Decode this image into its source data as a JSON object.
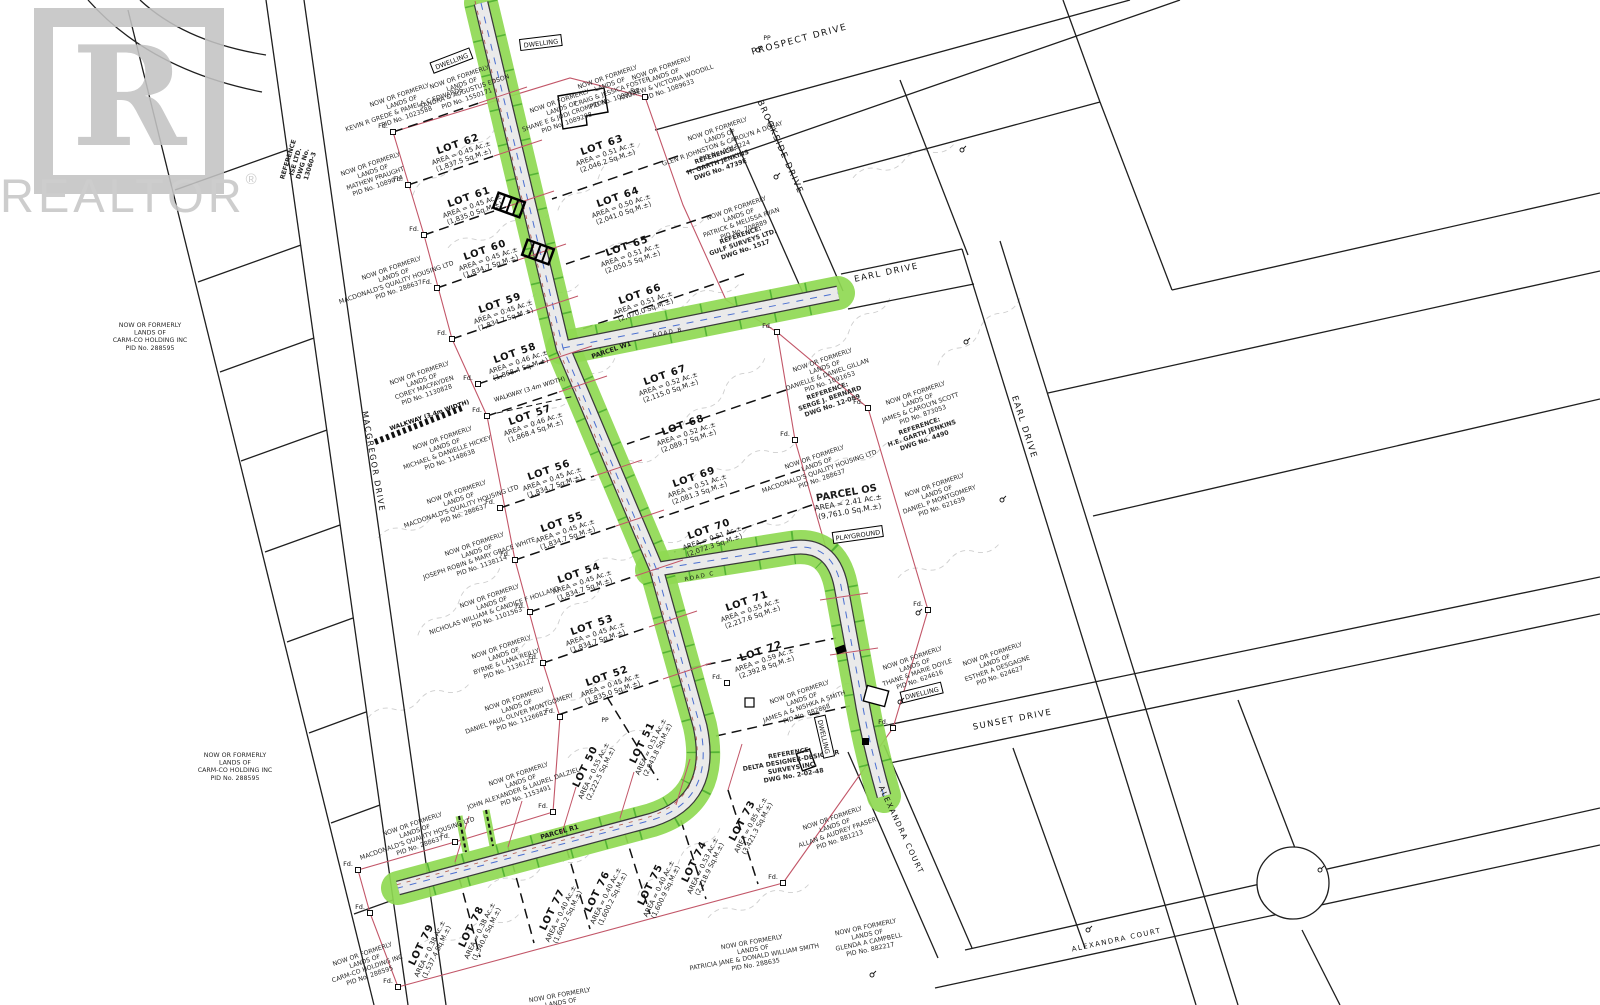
{
  "watermark": {
    "logo_letter": "R",
    "brand": "REALTOR",
    "registered": "®"
  },
  "colors": {
    "road_green": "#8fd952",
    "road_green_tick": "#2f9e1f",
    "road_surface": "#eaeaea",
    "road_edge": "#3a3a3a",
    "boundary_red": "#c25668",
    "parcel_line": "#1f1f1f",
    "contour_gray": "#c6c6c6",
    "centerline_blue": "#4a6fd0",
    "utility_red": "#b05548",
    "watermark_gray": "#c3c3c3"
  },
  "road_labels": [
    {
      "text": "PROSPECT DRIVE",
      "x": 800,
      "y": 42,
      "rot": -15,
      "size": 9
    },
    {
      "text": "BROOKSIDE DRIVE",
      "x": 778,
      "y": 148,
      "rot": 66,
      "size": 8.5
    },
    {
      "text": "EARL DRIVE",
      "x": 887,
      "y": 275,
      "rot": -12,
      "size": 8.5
    },
    {
      "text": "EARL DRIVE",
      "x": 1022,
      "y": 428,
      "rot": 72,
      "size": 8.5
    },
    {
      "text": "SUNSET DRIVE",
      "x": 1013,
      "y": 722,
      "rot": -11,
      "size": 8.5
    },
    {
      "text": "ALEXANDRA COURT",
      "x": 899,
      "y": 831,
      "rot": 65,
      "size": 7.5
    },
    {
      "text": "ALEXANDRA COURT",
      "x": 1117,
      "y": 942,
      "rot": -12,
      "size": 7
    },
    {
      "text": "MACGREGOR DRIVE",
      "x": 371,
      "y": 462,
      "rot": 80,
      "size": 8
    },
    {
      "text": "ROAD B",
      "x": 668,
      "y": 334,
      "rot": -11,
      "size": 5.5
    },
    {
      "text": "ROAD C",
      "x": 700,
      "y": 578,
      "rot": -12,
      "size": 5.5
    }
  ],
  "parcel_labels": [
    {
      "lines": [
        "PARCEL W1"
      ],
      "x": 612,
      "y": 352,
      "rot": -19,
      "size": 6.5,
      "bold": true
    },
    {
      "lines": [
        "PARCEL R1"
      ],
      "x": 560,
      "y": 834,
      "rot": -16,
      "size": 6.5,
      "bold": true
    },
    {
      "lines": [
        "PARCEL OS",
        "AREA = 2.41 Ac.±",
        "(9,761.0 Sq.M.±)"
      ],
      "x": 847,
      "y": 496,
      "rot": -10,
      "size": 10,
      "bold": true,
      "subsize": 7.5
    }
  ],
  "lots": [
    {
      "name": "LOT 62",
      "area": "AREA = 0.45 Ac.±",
      "sqm": "(1,837.5 Sq.M.±)",
      "x": 459,
      "y": 147,
      "rot": -19
    },
    {
      "name": "LOT 61",
      "area": "AREA = 0.45 Ac.±",
      "sqm": "(1,835.0 Sq.M.±)",
      "x": 470,
      "y": 200,
      "rot": -19
    },
    {
      "name": "LOT 60",
      "area": "AREA = 0.45 Ac.±",
      "sqm": "(1,834.7 Sq.M.±)",
      "x": 486,
      "y": 253,
      "rot": -19
    },
    {
      "name": "LOT 59",
      "area": "AREA = 0.45 Ac.±",
      "sqm": "(1,834.7 Sq.M.±)",
      "x": 501,
      "y": 306,
      "rot": -19
    },
    {
      "name": "LOT 58",
      "area": "AREA = 0.46 Ac.±",
      "sqm": "(1,868.4 Sq.M.±)",
      "x": 516,
      "y": 356,
      "rot": -19
    },
    {
      "name": "LOT 57",
      "area": "AREA = 0.46 Ac.±",
      "sqm": "(1,868.4 Sq.M.±)",
      "x": 531,
      "y": 418,
      "rot": -19
    },
    {
      "name": "LOT 56",
      "area": "AREA = 0.45 Ac.±",
      "sqm": "(1,834.7 Sq.M.±)",
      "x": 550,
      "y": 473,
      "rot": -19
    },
    {
      "name": "LOT 55",
      "area": "AREA = 0.45 Ac.±",
      "sqm": "(1,834.7 Sq.M.±)",
      "x": 563,
      "y": 525,
      "rot": -19
    },
    {
      "name": "LOT 54",
      "area": "AREA = 0.45 Ac.±",
      "sqm": "(1,834.7 Sq.M.±)",
      "x": 580,
      "y": 576,
      "rot": -19
    },
    {
      "name": "LOT 53",
      "area": "AREA = 0.45 Ac.±",
      "sqm": "(1,834.7 Sq.M.±)",
      "x": 593,
      "y": 628,
      "rot": -19
    },
    {
      "name": "LOT 52",
      "area": "AREA = 0.45 Ac.±",
      "sqm": "(1,835.0 Sq.M.±)",
      "x": 608,
      "y": 679,
      "rot": -19
    },
    {
      "name": "LOT 63",
      "area": "AREA = 0.51 Ac.±",
      "sqm": "(2,046.2 Sq.M.±)",
      "x": 603,
      "y": 148,
      "rot": -19
    },
    {
      "name": "LOT 64",
      "area": "AREA = 0.50 Ac.±",
      "sqm": "(2,041.0 Sq.M.±)",
      "x": 619,
      "y": 200,
      "rot": -19
    },
    {
      "name": "LOT 65",
      "area": "AREA = 0.51 Ac.±",
      "sqm": "(2,050.5 Sq.M.±)",
      "x": 628,
      "y": 249,
      "rot": -19
    },
    {
      "name": "LOT 66",
      "area": "AREA = 0.51 Ac.±",
      "sqm": "(2,070.0 Sq.M.±)",
      "x": 641,
      "y": 297,
      "rot": -19
    },
    {
      "name": "LOT 67",
      "area": "AREA = 0.52 Ac.±",
      "sqm": "(2,115.0 Sq.M.±)",
      "x": 666,
      "y": 378,
      "rot": -19
    },
    {
      "name": "LOT 68",
      "area": "AREA = 0.52 Ac.±",
      "sqm": "(2,089.7 Sq.M.±)",
      "x": 684,
      "y": 428,
      "rot": -19
    },
    {
      "name": "LOT 69",
      "area": "AREA = 0.51 Ac.±",
      "sqm": "(2,081.3 Sq.M.±)",
      "x": 695,
      "y": 480,
      "rot": -19
    },
    {
      "name": "LOT 70",
      "area": "AREA = 0.51 Ac.±",
      "sqm": "(2,072.3 Sq.M.±)",
      "x": 710,
      "y": 532,
      "rot": -19
    },
    {
      "name": "LOT 71",
      "area": "AREA = 0.55 Ac.±",
      "sqm": "(2,217.6 Sq.M.±)",
      "x": 748,
      "y": 604,
      "rot": -19
    },
    {
      "name": "LOT 72",
      "area": "AREA = 0.59 Ac.±",
      "sqm": "(2,392.8 Sq.M.±)",
      "x": 762,
      "y": 654,
      "rot": -19
    },
    {
      "name": "LOT 50",
      "area": "AREA = 0.55 Ac.±",
      "sqm": "(2,222.5 Sq.M.±)",
      "x": 588,
      "y": 768,
      "rot": -64
    },
    {
      "name": "LOT 51",
      "area": "AREA = 0.51 Ac.±",
      "sqm": "(2,043.8 Sq.M.±)",
      "x": 645,
      "y": 744,
      "rot": -64
    },
    {
      "name": "LOT 73",
      "area": "AREA = 0.85 Ac.±",
      "sqm": "(3,421.3 Sq.M.±)",
      "x": 745,
      "y": 822,
      "rot": -62
    },
    {
      "name": "LOT 74",
      "area": "AREA = 0.53 Ac.±",
      "sqm": "(2,118.9 Sq.M.±)",
      "x": 697,
      "y": 863,
      "rot": -64
    },
    {
      "name": "LOT 75",
      "area": "AREA = 0.40 Ac.±",
      "sqm": "(1,600.9 Sq.M.±)",
      "x": 653,
      "y": 886,
      "rot": -64
    },
    {
      "name": "LOT 76",
      "area": "AREA = 0.40 Ac.±",
      "sqm": "(1,600.2 Sq.M.±)",
      "x": 600,
      "y": 893,
      "rot": -64
    },
    {
      "name": "LOT 77",
      "area": "AREA = 0.40 Ac.±",
      "sqm": "(1,600.2 Sq.M.±)",
      "x": 555,
      "y": 911,
      "rot": -64
    },
    {
      "name": "LOT 78",
      "area": "AREA = 0.38 Ac.±",
      "sqm": "(1,540.6 Sq.M.±)",
      "x": 474,
      "y": 928,
      "rot": -64
    },
    {
      "name": "LOT 79",
      "area": "AREA = 0.38 Ac.±",
      "sqm": "(1,537.4 Sq.M.±)",
      "x": 424,
      "y": 946,
      "rot": -64
    }
  ],
  "owners": [
    {
      "lines": [
        "NOW OR FORMERLY",
        "LANDS OF",
        "CARM-CO HOLDING INC",
        "PID No. 288595"
      ],
      "x": 150,
      "y": 327,
      "rot": 0
    },
    {
      "lines": [
        "NOW OR FORMERLY",
        "LANDS OF",
        "CARM-CO HOLDING INC",
        "PID No. 288595"
      ],
      "x": 235,
      "y": 757,
      "rot": 0
    },
    {
      "lines": [
        "NOW OR FORMERLY",
        "LANDS OF",
        "CARM-CO HOLDING INC",
        "PID No. 288595"
      ],
      "x": 363,
      "y": 956,
      "rot": -19
    },
    {
      "lines": [
        "NOW OR FORMERLY",
        "LANDS OF",
        "KEVIN R GREDE & PAMELA C EDWARDS",
        "PID No. 1023588"
      ],
      "x": 400,
      "y": 97,
      "rot": -19
    },
    {
      "lines": [
        "NOW OR FORMERLY",
        "LANDS OF",
        "MATHEW PRAUGHT",
        "PID No. 1089074"
      ],
      "x": 371,
      "y": 166,
      "rot": -19
    },
    {
      "lines": [
        "NOW OR FORMERLY",
        "LANDS OF",
        "SANDRA & AUGUSTUS EDSON",
        "PID No. 1550171"
      ],
      "x": 460,
      "y": 79,
      "rot": -19
    },
    {
      "lines": [
        "NOW OR FORMERLY",
        "LANDS OF",
        "SHANE E & JODI CROMPTON",
        "PID No. 1089208"
      ],
      "x": 560,
      "y": 103,
      "rot": -19
    },
    {
      "lines": [
        "NOW OR FORMERLY",
        "LANDS OF",
        "CRAIG & JESSICA FOSTER",
        "PID No. 1089187"
      ],
      "x": 608,
      "y": 79,
      "rot": -19
    },
    {
      "lines": [
        "NOW OR FORMERLY",
        "LANDS OF",
        "ANDREW & VICTORIA WOODILL",
        "PID No. 1089633"
      ],
      "x": 662,
      "y": 70,
      "rot": -19
    },
    {
      "lines": [
        "NOW OR FORMERLY",
        "LANDS OF",
        "GLEN R JOHNSTON & CAROLYN A DUSAY",
        "PID No. 1018224"
      ],
      "x": 718,
      "y": 131,
      "rot": -19
    },
    {
      "lines": [
        "REFERENCE:",
        "H. GARTH JENKINS",
        "DWG No. 4739E"
      ],
      "x": 716,
      "y": 157,
      "rot": -19,
      "bold": true
    },
    {
      "lines": [
        "NOW OR FORMERLY",
        "LANDS OF",
        "PATRICK & MELISSA RYAN",
        "PID No. 708889"
      ],
      "x": 737,
      "y": 210,
      "rot": -19
    },
    {
      "lines": [
        "REFERENCE:",
        "GULF SURVEYS LTD.",
        "DWG No. 1517"
      ],
      "x": 741,
      "y": 237,
      "rot": -19,
      "bold": true
    },
    {
      "lines": [
        "NOW OR FORMERLY",
        "LANDS OF",
        "MACDONALD'S QUALITY HOUSING LTD",
        "PID No. 288637"
      ],
      "x": 392,
      "y": 270,
      "rot": -19
    },
    {
      "lines": [
        "NOW OR FORMERLY",
        "LANDS OF",
        "COREY MACFAYDEN",
        "PID No. 1130828"
      ],
      "x": 420,
      "y": 375,
      "rot": -19
    },
    {
      "lines": [
        "NOW OR FORMERLY",
        "LANDS OF",
        "MICHAEL & DANIELLE HICKEY",
        "PID No. 1148638"
      ],
      "x": 443,
      "y": 440,
      "rot": -19
    },
    {
      "lines": [
        "NOW OR FORMERLY",
        "LANDS OF",
        "MACDONALD'S QUALITY HOUSING LTD",
        "PID No. 288637"
      ],
      "x": 457,
      "y": 494,
      "rot": -19
    },
    {
      "lines": [
        "NOW OR FORMERLY",
        "LANDS OF",
        "JOSEPH ROBIN & MARY GRACE WHITE",
        "PID No. 1138114"
      ],
      "x": 475,
      "y": 546,
      "rot": -19
    },
    {
      "lines": [
        "NOW OR FORMERLY",
        "LANDS OF",
        "NICHOLAS WILLIAM & CANDICE F HOLLAND",
        "PID No. 1101563"
      ],
      "x": 490,
      "y": 598,
      "rot": -19
    },
    {
      "lines": [
        "NOW OR FORMERLY",
        "LANDS OF",
        "BYRNE & LANA REILLY",
        "PID No. 1136122"
      ],
      "x": 502,
      "y": 649,
      "rot": -19
    },
    {
      "lines": [
        "NOW OR FORMERLY",
        "LANDS OF",
        "DANIEL PAUL OLIVER MONTGOMERY",
        "PID No. 1126682"
      ],
      "x": 515,
      "y": 701,
      "rot": -19
    },
    {
      "lines": [
        "NOW OR FORMERLY",
        "LANDS OF",
        "JOHN ALEXANDER & LAUREL DALZIEL",
        "PID No. 1153491"
      ],
      "x": 519,
      "y": 776,
      "rot": -19
    },
    {
      "lines": [
        "NOW OR FORMERLY",
        "LANDS OF",
        "MACDONALD'S QUALITY HOUSING LTD",
        "PID No. 288637"
      ],
      "x": 413,
      "y": 826,
      "rot": -19
    },
    {
      "lines": [
        "NOW OR FORMERLY",
        "LANDS OF",
        "PATRICIA JANE & DONALD WILLIAM SMITH",
        "PID No. 288635"
      ],
      "x": 752,
      "y": 944,
      "rot": -10
    },
    {
      "lines": [
        "NOW OR FORMERLY",
        "LANDS OF"
      ],
      "x": 560,
      "y": 997,
      "rot": -10
    },
    {
      "lines": [
        "NOW OR FORMERLY",
        "LANDS OF",
        "DANIELLE & DANIEL GILLAN",
        "PID No. 1091653"
      ],
      "x": 823,
      "y": 362,
      "rot": -19
    },
    {
      "lines": [
        "REFERENCE:",
        "SERGE J. BERNARD",
        "DWG No. 12-089"
      ],
      "x": 828,
      "y": 393,
      "rot": -19,
      "bold": true
    },
    {
      "lines": [
        "NOW OR FORMERLY",
        "LANDS OF",
        "JAMES & CAROLYN SCOTT",
        "PID No. 873053"
      ],
      "x": 916,
      "y": 395,
      "rot": -19
    },
    {
      "lines": [
        "REFERENCE:",
        "H.E. GARTH JENKINS",
        "DWG No. 4490"
      ],
      "x": 920,
      "y": 428,
      "rot": -19,
      "bold": true
    },
    {
      "lines": [
        "NOW OR FORMERLY",
        "LANDS OF",
        "MACDONALD'S QUALITY HOUSING LTD",
        "PID No. 288637"
      ],
      "x": 815,
      "y": 459,
      "rot": -19
    },
    {
      "lines": [
        "NOW OR FORMERLY",
        "LANDS OF",
        "DANIEL P MONTGOMERY",
        "PID No. 621639"
      ],
      "x": 935,
      "y": 487,
      "rot": -19
    },
    {
      "lines": [
        "NOW OR FORMERLY",
        "LANDS OF",
        "THANE & MARIE DOYLE",
        "PID No. 624616"
      ],
      "x": 913,
      "y": 660,
      "rot": -19
    },
    {
      "lines": [
        "NOW OR FORMERLY",
        "LANDS OF",
        "ESTHER A DESGAGNE",
        "PID No. 624627"
      ],
      "x": 993,
      "y": 656,
      "rot": -19
    },
    {
      "lines": [
        "NOW OR FORMERLY",
        "LANDS OF",
        "JAMES A & NISHKA A SMITH",
        "PID No. 882868"
      ],
      "x": 800,
      "y": 694,
      "rot": -19
    },
    {
      "lines": [
        "REFERENCE:",
        "DELTA DESIGNER-DESIGNER",
        "SURVEYS INC.",
        "DWG No. 2-02-48"
      ],
      "x": 790,
      "y": 755,
      "rot": -10,
      "bold": true
    },
    {
      "lines": [
        "NOW OR FORMERLY",
        "LANDS OF",
        "ALLAN & AUDREY FRASER",
        "PID No. 881213"
      ],
      "x": 833,
      "y": 820,
      "rot": -19
    },
    {
      "lines": [
        "NOW OR FORMERLY",
        "LANDS OF",
        "GLENDA A CAMPBELL",
        "PID No. 882217"
      ],
      "x": 866,
      "y": 929,
      "rot": -12
    },
    {
      "lines": [
        "REFERENCE",
        "ISE LTD.",
        "DWG No.",
        "13060-3"
      ],
      "x": 290,
      "y": 160,
      "rot": -73,
      "bold": true
    }
  ],
  "boxed_labels": [
    {
      "text": "DWELLING",
      "x": 452,
      "y": 62,
      "rot": -21
    },
    {
      "text": "DWELLING",
      "x": 541,
      "y": 44,
      "rot": -7
    },
    {
      "text": "DWELLING",
      "x": 823,
      "y": 737,
      "rot": 77
    },
    {
      "text": "DWELLING",
      "x": 922,
      "y": 694,
      "rot": -14
    },
    {
      "text": "PLAYGROUND",
      "x": 858,
      "y": 536,
      "rot": -8
    }
  ],
  "walkway_labels": [
    {
      "text": "WALKWAY (3.4m WIDTH)",
      "x": 430,
      "y": 417,
      "rot": -19,
      "bold": true
    },
    {
      "text": "WALKWAY (3.4m WIDTH)",
      "x": 530,
      "y": 391,
      "rot": -17,
      "bold": false
    }
  ],
  "fd_label": "Fd.",
  "fd_markers": [
    {
      "x": 393,
      "y": 132
    },
    {
      "x": 408,
      "y": 185
    },
    {
      "x": 424,
      "y": 235
    },
    {
      "x": 437,
      "y": 288
    },
    {
      "x": 452,
      "y": 339
    },
    {
      "x": 478,
      "y": 384
    },
    {
      "x": 487,
      "y": 416
    },
    {
      "x": 500,
      "y": 508
    },
    {
      "x": 515,
      "y": 560
    },
    {
      "x": 530,
      "y": 612
    },
    {
      "x": 543,
      "y": 663
    },
    {
      "x": 560,
      "y": 717
    },
    {
      "x": 553,
      "y": 812
    },
    {
      "x": 455,
      "y": 842
    },
    {
      "x": 358,
      "y": 870
    },
    {
      "x": 370,
      "y": 913
    },
    {
      "x": 398,
      "y": 987
    },
    {
      "x": 645,
      "y": 97
    },
    {
      "x": 777,
      "y": 332
    },
    {
      "x": 795,
      "y": 440
    },
    {
      "x": 868,
      "y": 408
    },
    {
      "x": 928,
      "y": 610
    },
    {
      "x": 893,
      "y": 728
    },
    {
      "x": 783,
      "y": 883
    },
    {
      "x": 727,
      "y": 683
    }
  ],
  "pp_label": "PP",
  "pp_markers": [
    {
      "x": 767,
      "y": 40
    },
    {
      "x": 605,
      "y": 722
    }
  ]
}
